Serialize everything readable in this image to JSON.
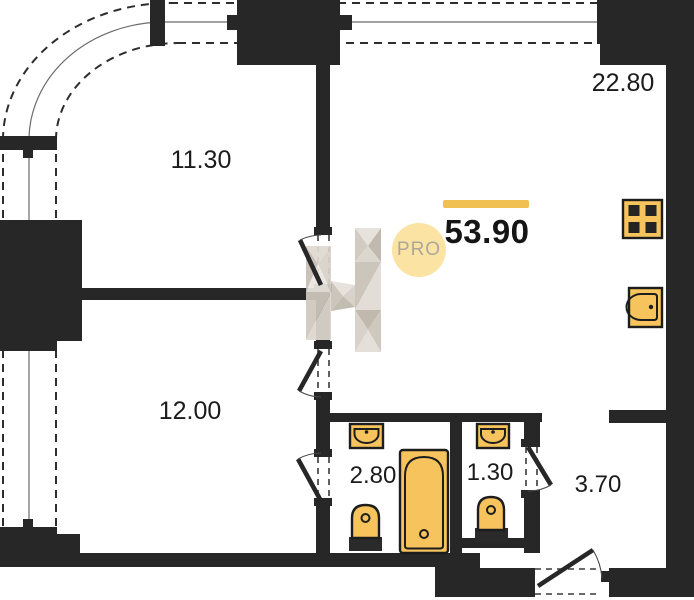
{
  "plan": {
    "type": "apartment-floor-plan",
    "total_area_label": "53.90",
    "watermark_badge": "PRO",
    "rooms": [
      {
        "name": "room-upper-left",
        "area_label": "11.30"
      },
      {
        "name": "kitchen-living-room",
        "area_label": "22.80"
      },
      {
        "name": "room-lower-left",
        "area_label": "12.00"
      },
      {
        "name": "bathroom",
        "area_label": "2.80"
      },
      {
        "name": "wc",
        "area_label": "1.30"
      },
      {
        "name": "hallway",
        "area_label": "3.70"
      }
    ],
    "fixtures": [
      "stove-icon",
      "kitchen-sink-icon",
      "bathtub-icon",
      "bathroom-sink-icon",
      "bathroom-toilet-icon",
      "wc-sink-icon",
      "wc-toilet-icon"
    ],
    "colors": {
      "walls": "#272727",
      "fixture_fill": "#F6C35C",
      "accent_bar": "#F0C052",
      "pro_circle_fill": "#FBE4A3",
      "pro_text": "#ACA79C",
      "background": "#FFFFFF"
    }
  }
}
